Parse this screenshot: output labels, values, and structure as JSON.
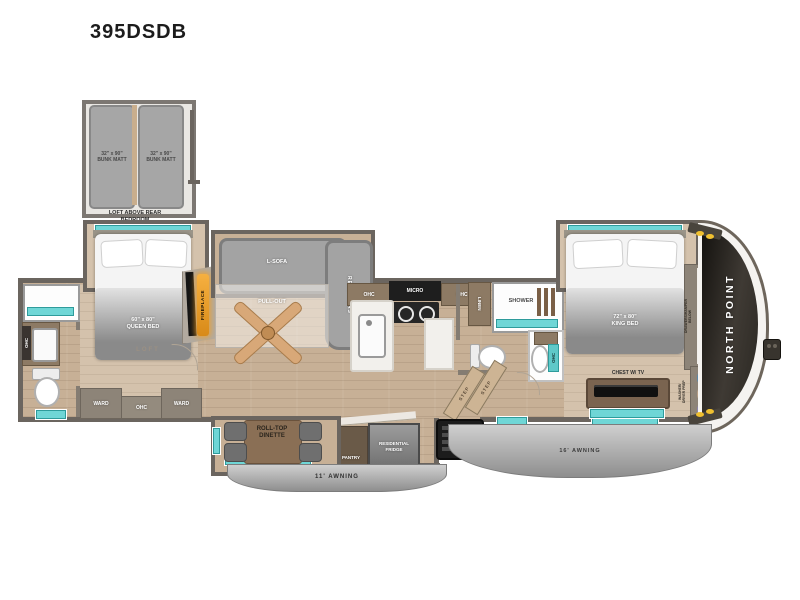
{
  "title": "395DSDB",
  "brand": "NORTH POINT",
  "loft": {
    "bunk_left": "32\" x 90\"\nBUNK MATT",
    "bunk_right": "32\" x 90\"\nBUNK MATT",
    "caption": "LOFT ABOVE REAR\nBEDROOM"
  },
  "rear_bedroom": {
    "bed": "60\" x 80\"\nQUEEN BED",
    "loft": "LOFT",
    "ward_left": "WARD",
    "ohc": "OHC",
    "ward_right": "WARD"
  },
  "rear_bath": {
    "ohc": "OHC"
  },
  "living": {
    "sofa": "L-SOFA",
    "pullout": "PULL-OUT",
    "recliners": "RECLINERS",
    "fireplace": "FIREPLACE"
  },
  "kitchen": {
    "ohc_left": "OHC",
    "micro": "MICRO",
    "ohc_right": "OHC",
    "linen": "LINEN",
    "pantry": "PANTRY",
    "fridge": "RESIDENTIAL\nFRIDGE"
  },
  "mid_bath": {
    "shower": "SHOWER",
    "ohc": "OHC",
    "step_1": "STEP",
    "step_2": "STEP"
  },
  "front_bedroom": {
    "bed": "72\" x 80\"\nKING BED",
    "chest": "CHEST W/ TV",
    "closet_note": "DRAWERS/HAMPER\nBELOW",
    "laundry_note": "WASHER/\nDRYER PREP"
  },
  "dinette": {
    "label": "ROLL-TOP\nDINETTE"
  },
  "awnings": {
    "curbside": "11' AWNING",
    "main": "16' AWNING"
  },
  "closet": {
    "hanger_colors": [
      "#7ab4e0",
      "#f0d0b0",
      "#b8b2e4",
      "#7ab4e0",
      "#f0d0b0",
      "#b8b2e4"
    ],
    "lower_hanger_colors": [
      "#7ab4e0",
      "#f0d0b0",
      "#b8b2e4"
    ]
  },
  "colors": {
    "teal": "#6fd6d6",
    "wall": "#6b655f",
    "amber": "#f0a030"
  }
}
